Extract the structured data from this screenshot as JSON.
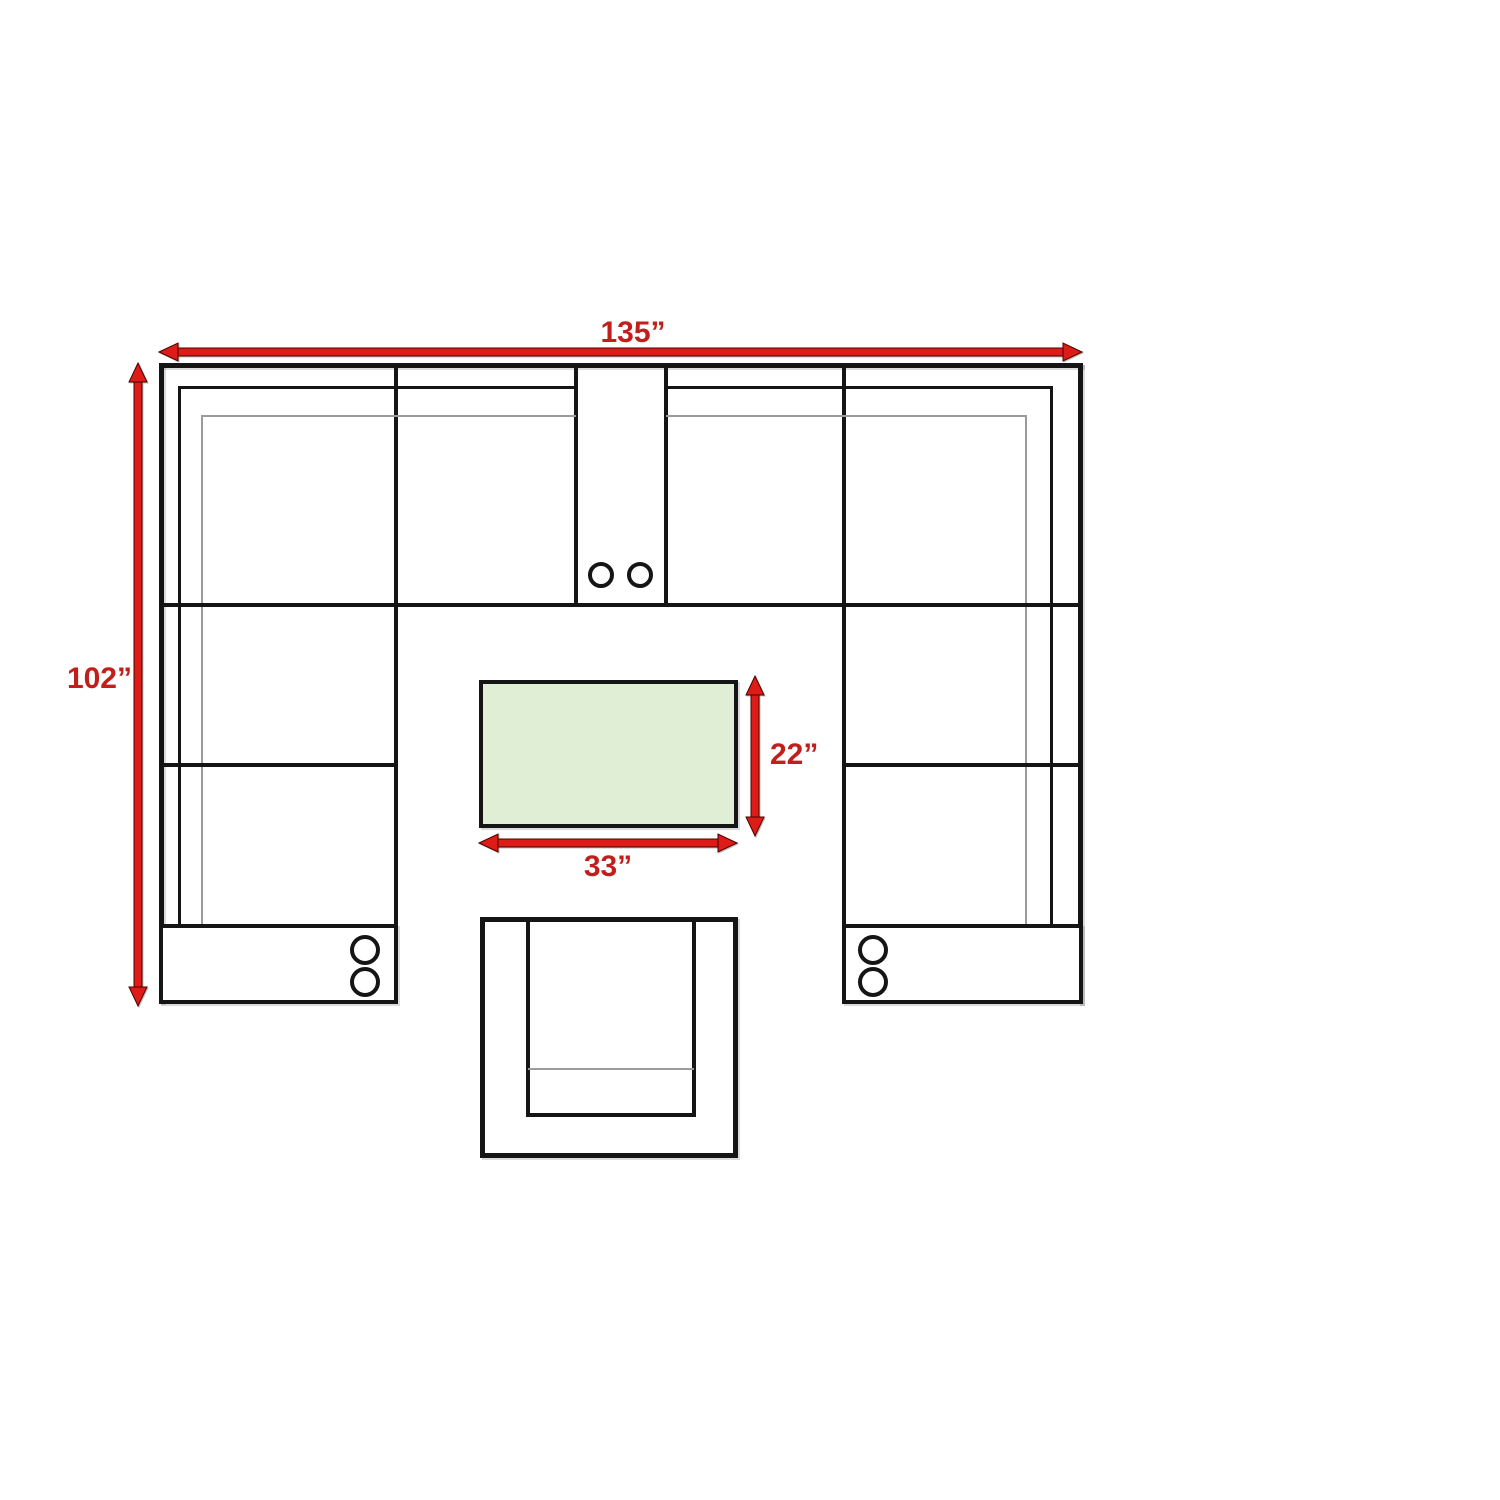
{
  "diagram": {
    "kind": "furniture-dimension-floorplan",
    "dimensions": {
      "sectional_width_label": "135”",
      "sectional_depth_label": "102”",
      "table_width_label": "33”",
      "table_depth_label": "22”"
    },
    "colors": {
      "dimension_text_red": "#c01f1c",
      "arrow_red": "#dd1b17",
      "table_fill_green": "#e0eed6",
      "outline_black": "#151515",
      "detail_gray": "#9b9b9b"
    },
    "icons": {
      "cupholder": "circle",
      "dimension_arrow": "double-headed-arrow"
    }
  }
}
